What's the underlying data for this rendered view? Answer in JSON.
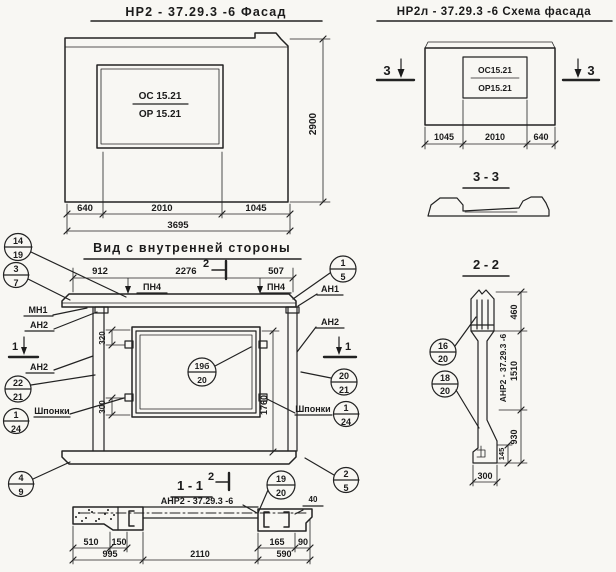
{
  "facade": {
    "title": "НР2 - 37.29.3  -6   Фасад",
    "mark_top": "ОС 15.21",
    "mark_bot": "ОР 15.21",
    "dim_height": "2900",
    "dim_640": "640",
    "dim_2010": "2010",
    "dim_1045": "1045",
    "dim_total": "3695"
  },
  "schema": {
    "title": "НР2л - 37.29.3  -6  Схема фасада",
    "mark_top": "ОС15.21",
    "mark_bot": "ОР15.21",
    "sec_left": "3",
    "sec_right": "3",
    "dim_1045": "1045",
    "dim_2010": "2010",
    "dim_640": "640"
  },
  "sec33": {
    "title": "3 - 3"
  },
  "sec22": {
    "title": "2 - 2",
    "c16": {
      "n": "16",
      "d": "20"
    },
    "c18": {
      "n": "18",
      "d": "20"
    },
    "label": "АНР2 - 37.29.3 -6",
    "dim_460": "460",
    "dim_1510": "1510",
    "dim_930": "930",
    "dim_145": "145",
    "dim_300": "300"
  },
  "inner": {
    "title": "Вид с внутренней  стороны",
    "sec2": "2",
    "sec1l": "1",
    "sec1r": "1",
    "dim_912": "912",
    "dim_2276": "2276",
    "dim_507": "507",
    "pn4l": "ПН4",
    "pn4r": "ПН4",
    "mn1": "МН1",
    "an2_tl": "АН2",
    "an2_l": "АН2",
    "an1_r": "АН1",
    "an2_r": "АН2",
    "shponki_l": "Шпонки",
    "shponki_r": "Шпонки",
    "dim_320": "320",
    "dim_300": "300",
    "dim_1760": "1760",
    "c14_19": {
      "n": "14",
      "d": "19"
    },
    "c3_7": {
      "n": "3",
      "d": "7"
    },
    "c1_5": {
      "n": "1",
      "d": "5"
    },
    "c22_21": {
      "n": "22",
      "d": "21"
    },
    "c1_24l": {
      "n": "1",
      "d": "24"
    },
    "c4_9": {
      "n": "4",
      "d": "9"
    },
    "c20_21": {
      "n": "20",
      "d": "21"
    },
    "c1_24r": {
      "n": "1",
      "d": "24"
    },
    "c2_5": {
      "n": "2",
      "d": "5"
    },
    "c19b": {
      "n": "19б",
      "d": "20"
    }
  },
  "sec11": {
    "title": "1 - 1",
    "sec2": "2",
    "label": "АНР2 - 37.29.3  -6",
    "c19_20": {
      "n": "19",
      "d": "20"
    },
    "dim_510": "510",
    "dim_150": "150",
    "dim_995": "995",
    "dim_2110": "2110",
    "dim_165": "165",
    "dim_90": "90",
    "dim_590": "590",
    "dim_40": "40"
  }
}
